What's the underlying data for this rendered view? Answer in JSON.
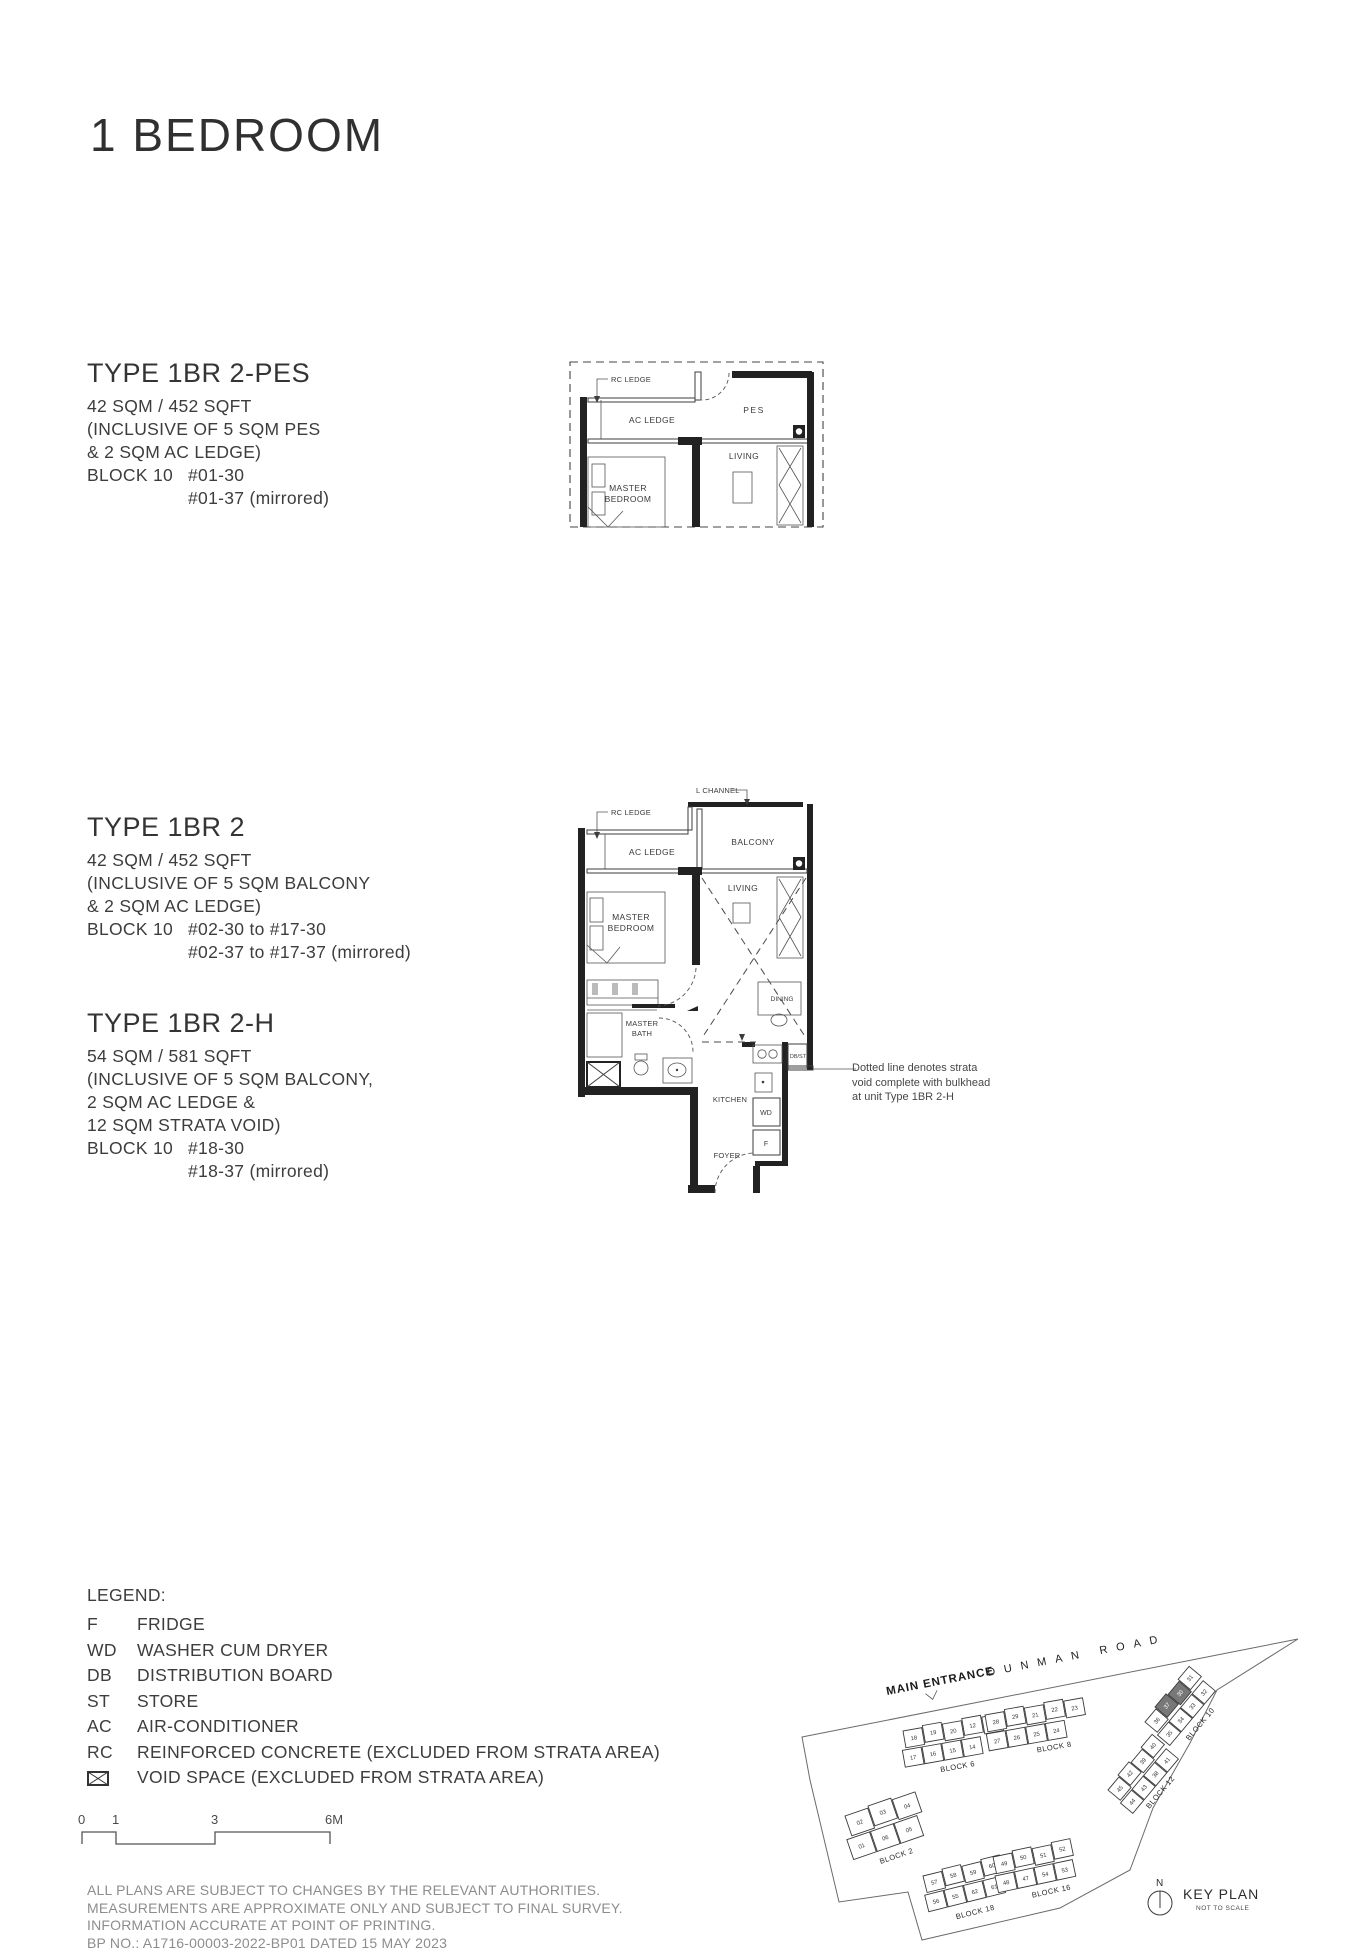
{
  "page": {
    "title": "1 BEDROOM"
  },
  "units": [
    {
      "heading": "TYPE 1BR 2-PES",
      "area": "42 SQM / 452 SQFT",
      "inclusive_lines": [
        "(INCLUSIVE OF 5 SQM PES",
        "& 2 SQM AC LEDGE)"
      ],
      "block_label": "BLOCK 10",
      "stacks": [
        "#01-30",
        "#01-37 (mirrored)"
      ]
    },
    {
      "heading": "TYPE 1BR 2",
      "area": "42 SQM / 452 SQFT",
      "inclusive_lines": [
        "(INCLUSIVE OF 5 SQM BALCONY",
        "& 2 SQM AC LEDGE)"
      ],
      "block_label": "BLOCK 10",
      "stacks": [
        "#02-30 to #17-30",
        "#02-37 to #17-37 (mirrored)"
      ]
    },
    {
      "heading": "TYPE 1BR 2-H",
      "area": "54 SQM / 581 SQFT",
      "inclusive_lines": [
        "(INCLUSIVE OF 5 SQM BALCONY,",
        "2 SQM AC LEDGE &",
        "12 SQM STRATA VOID)"
      ],
      "block_label": "BLOCK 10",
      "stacks": [
        "#18-30",
        "#18-37 (mirrored)"
      ]
    }
  ],
  "plan1": {
    "labels": {
      "rc_ledge": "RC LEDGE",
      "ac_ledge": "AC LEDGE",
      "pes": "PES",
      "living": "LIVING",
      "master_1": "MASTER",
      "master_2": "BEDROOM"
    }
  },
  "plan2": {
    "labels": {
      "l_channel": "L CHANNEL",
      "rc_ledge": "RC LEDGE",
      "ac_ledge": "AC LEDGE",
      "balcony": "BALCONY",
      "living": "LIVING",
      "master_1": "MASTER",
      "master_2": "BEDROOM",
      "bath_1": "MASTER",
      "bath_2": "BATH",
      "dining": "DINING",
      "dbst": "DB/ST",
      "kitchen": "KITCHEN",
      "wd": "WD",
      "f": "F",
      "foyer": "FOYER"
    }
  },
  "annotation": {
    "lines": [
      "Dotted line denotes strata",
      "void complete with bulkhead",
      "at unit Type 1BR 2-H"
    ]
  },
  "legend": {
    "title": "LEGEND:",
    "items": [
      {
        "abbr": "F",
        "desc": "FRIDGE"
      },
      {
        "abbr": "WD",
        "desc": "WASHER CUM DRYER"
      },
      {
        "abbr": "DB",
        "desc": "DISTRIBUTION BOARD"
      },
      {
        "abbr": "ST",
        "desc": "STORE"
      },
      {
        "abbr": "AC",
        "desc": "AIR-CONDITIONER"
      },
      {
        "abbr": "RC",
        "desc": "REINFORCED CONCRETE (EXCLUDED FROM STRATA AREA)"
      }
    ],
    "void_item": {
      "desc": "VOID SPACE (EXCLUDED FROM STRATA AREA)"
    }
  },
  "scalebar": {
    "ticks": [
      "0",
      "1",
      "3",
      "6M"
    ]
  },
  "keyplan": {
    "main_entrance": "MAIN ENTRANCE",
    "road": "DUNMAN ROAD",
    "north": "N",
    "title": "KEY PLAN",
    "subtitle": "NOT TO SCALE",
    "highlighted": [
      "30",
      "37"
    ],
    "blocks": [
      {
        "name": "BLOCK 6",
        "x": 263,
        "y": 131,
        "angle": -10,
        "uw": 19,
        "uh": 17,
        "row2dx": -4,
        "lx": 30,
        "ly": 47,
        "rows": [
          [
            "18",
            "19",
            "20",
            "12",
            "13"
          ],
          [
            "17",
            "16",
            "15",
            "14"
          ]
        ]
      },
      {
        "name": "BLOCK 8",
        "x": 345,
        "y": 115,
        "angle": -10,
        "uw": 19,
        "uh": 17,
        "row2dx": -2,
        "lx": 45,
        "ly": 46,
        "rows": [
          [
            "28",
            "29",
            "21",
            "22",
            "23"
          ],
          [
            "27",
            "26",
            "25",
            "24"
          ]
        ]
      },
      {
        "name": "BLOCK 2",
        "x": 205,
        "y": 216,
        "angle": -19,
        "uw": 24,
        "uh": 21,
        "row2dx": -6,
        "lx": 18,
        "ly": 57,
        "rows": [
          [
            "02",
            "03",
            "04"
          ],
          [
            "01",
            "06",
            "05"
          ]
        ]
      },
      {
        "name": "BLOCK 18",
        "x": 283,
        "y": 276,
        "angle": -14,
        "uw": 19,
        "uh": 17,
        "row2dx": -3,
        "lx": 22,
        "ly": 50,
        "rows": [
          [
            "57",
            "58",
            "59",
            "60"
          ],
          [
            "56",
            "55",
            "62",
            "61"
          ]
        ]
      },
      {
        "name": "BLOCK 16",
        "x": 353,
        "y": 257,
        "angle": -12,
        "uw": 19,
        "uh": 17,
        "row2dx": -2,
        "lx": 30,
        "ly": 48,
        "rows": [
          [
            "49",
            "50",
            "51",
            "52"
          ],
          [
            "48",
            "47",
            "54",
            "53"
          ]
        ]
      },
      {
        "name": "BLOCK 10",
        "x": 505,
        "y": 122,
        "angle": -50,
        "uw": 17,
        "uh": 16,
        "row2dx": -2,
        "lx": 14,
        "ly": 46,
        "rows": [
          [
            "36",
            "37",
            "30",
            "31"
          ],
          [
            "35",
            "34",
            "33",
            "32"
          ]
        ]
      },
      {
        "name": "BLOCK 12",
        "x": 468,
        "y": 190,
        "angle": -50,
        "uw": 17,
        "uh": 16,
        "row2dx": -2,
        "lx": 12,
        "ly": 44,
        "rows": [
          [
            "45",
            "42",
            "39",
            "40"
          ],
          [
            "44",
            "43",
            "38",
            "41"
          ]
        ]
      }
    ]
  },
  "disclaimer": {
    "lines": [
      "ALL PLANS ARE SUBJECT TO CHANGES BY THE RELEVANT AUTHORITIES.",
      "MEASUREMENTS ARE APPROXIMATE ONLY AND SUBJECT TO FINAL SURVEY.",
      "INFORMATION ACCURATE AT POINT OF PRINTING.",
      "BP NO.: A1716-00003-2022-BP01 DATED 15 MAY 2023"
    ]
  }
}
